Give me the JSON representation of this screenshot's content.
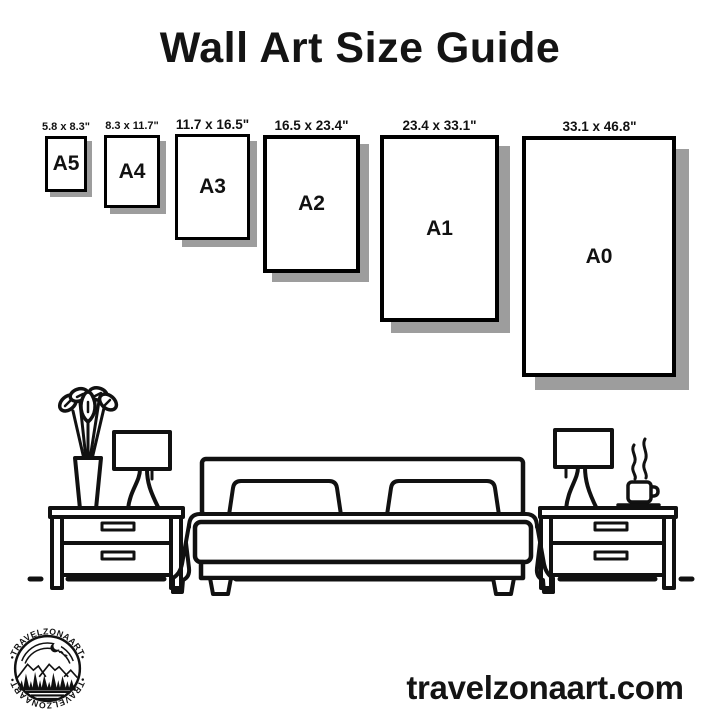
{
  "title": "Wall Art Size Guide",
  "sizes": [
    {
      "label": "A5",
      "dimensions": "5.8 x 8.3\""
    },
    {
      "label": "A4",
      "dimensions": "8.3 x 11.7\""
    },
    {
      "label": "A3",
      "dimensions": "11.7 x 16.5\""
    },
    {
      "label": "A2",
      "dimensions": "16.5 x 23.4\""
    },
    {
      "label": "A1",
      "dimensions": "23.4 x 33.1\""
    },
    {
      "label": "A0",
      "dimensions": "33.1 x 46.8\""
    }
  ],
  "logo": {
    "text_top": "•TRAVELZONAART•",
    "text_bottom": "•TRAVELZONAART•"
  },
  "website": "travelzonaart.com",
  "colors": {
    "ink": "#111111",
    "shadow": "#9d9d9d",
    "background": "#ffffff"
  },
  "illustration": {
    "items": [
      "plant-vase",
      "table-lamp-left",
      "nightstand-left",
      "double-bed",
      "nightstand-right",
      "table-lamp-right",
      "coffee-cup",
      "floor-line"
    ]
  }
}
